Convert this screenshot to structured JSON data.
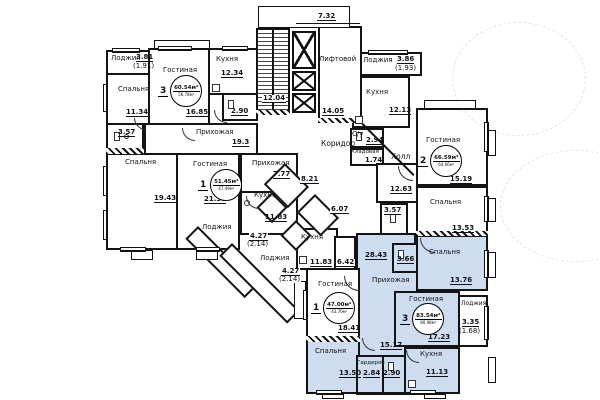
{
  "plan": {
    "common": {
      "corridor": "Коридор",
      "hall": "Холл",
      "lift_room": "Лифтовой",
      "lift_area": "14.05",
      "stairs_area": "12.04",
      "top_dim": "7.32"
    },
    "apt_a": {
      "loggia": "Лоджия",
      "loggia_area": "3.81",
      "loggia_area2": "(1.91)",
      "bedroom1": "Спальня",
      "bedroom1_area": "11.34",
      "wc1_area": "3.57",
      "living": "Гостиная",
      "rooms": "3",
      "total": "60.54м²",
      "sub": "56.78м²",
      "living_area": "16.85",
      "kitchen": "Кухня",
      "kitchen_area": "12.34",
      "wc2_area": "2.90",
      "hall": "Прихожая",
      "hall_area": "19.3",
      "bedroom2": "Спальня",
      "bedroom2_area": "19.43"
    },
    "apt_b": {
      "living": "Гостиная",
      "rooms": "1",
      "total": "51.45м²",
      "sub": "47.49м²",
      "living_area": "21.37",
      "hall": "Прихожая",
      "hall_area": "7.77",
      "wc_area": "8.21",
      "kitchen": "Кухня",
      "kitchen_area": "11.83",
      "wc2_area": "6.07",
      "loggia1": "Лоджия",
      "loggia1_area": "4.27",
      "loggia1_area2": "(2.14)",
      "loggia2": "Лоджия",
      "loggia2_area": "4.27",
      "loggia2_area2": "(2.14)"
    },
    "apt_c": {
      "loggia": "Лоджия",
      "loggia_area": "3.86",
      "loggia_area2": "(1.93)",
      "kitchen": "Кухня",
      "kitchen_area": "12.13",
      "wc": "С/у",
      "wc_area": "2.94",
      "storage": "Кладовая",
      "storage_area": "1.74",
      "room_area": "12.63",
      "living": "Гостиная",
      "rooms": "2",
      "total": "66.59м²",
      "sub": "64.66м²",
      "living_area": "15.19",
      "bedroom": "Спальня",
      "bedroom_area": "13.53",
      "wc2_area": "3.57"
    },
    "apt_d": {
      "bedroom1": "Спальня",
      "bedroom1_area": "13.76",
      "wc_area": "3.66",
      "hall": "Прихожая",
      "hall_area": "28.43",
      "hall_area2": "15.17",
      "living": "Гостиная",
      "rooms": "3",
      "total": "83.54м²",
      "sub": "80.98м²",
      "living_area": "17.23",
      "loggia": "Лоджия",
      "loggia_area": "3.35",
      "loggia_area2": "(1.68)",
      "kitchen": "Кухня",
      "kitchen_area": "11.13",
      "wardrobe": "Гардероб",
      "wardrobe_area": "2.84",
      "wc2_area": "2.90",
      "bedroom2": "Спальня",
      "bedroom2_area": "13.50"
    },
    "apt_e": {
      "living": "Гостиная",
      "rooms": "1",
      "total": "47.00м²",
      "sub": "43.70м²",
      "living_area": "18.41",
      "kitchen": "Кухня",
      "kitchen_area": "11.83",
      "wc_area": "6.42"
    },
    "colors": {
      "highlight": "#cddcee",
      "wall": "#141414"
    }
  }
}
